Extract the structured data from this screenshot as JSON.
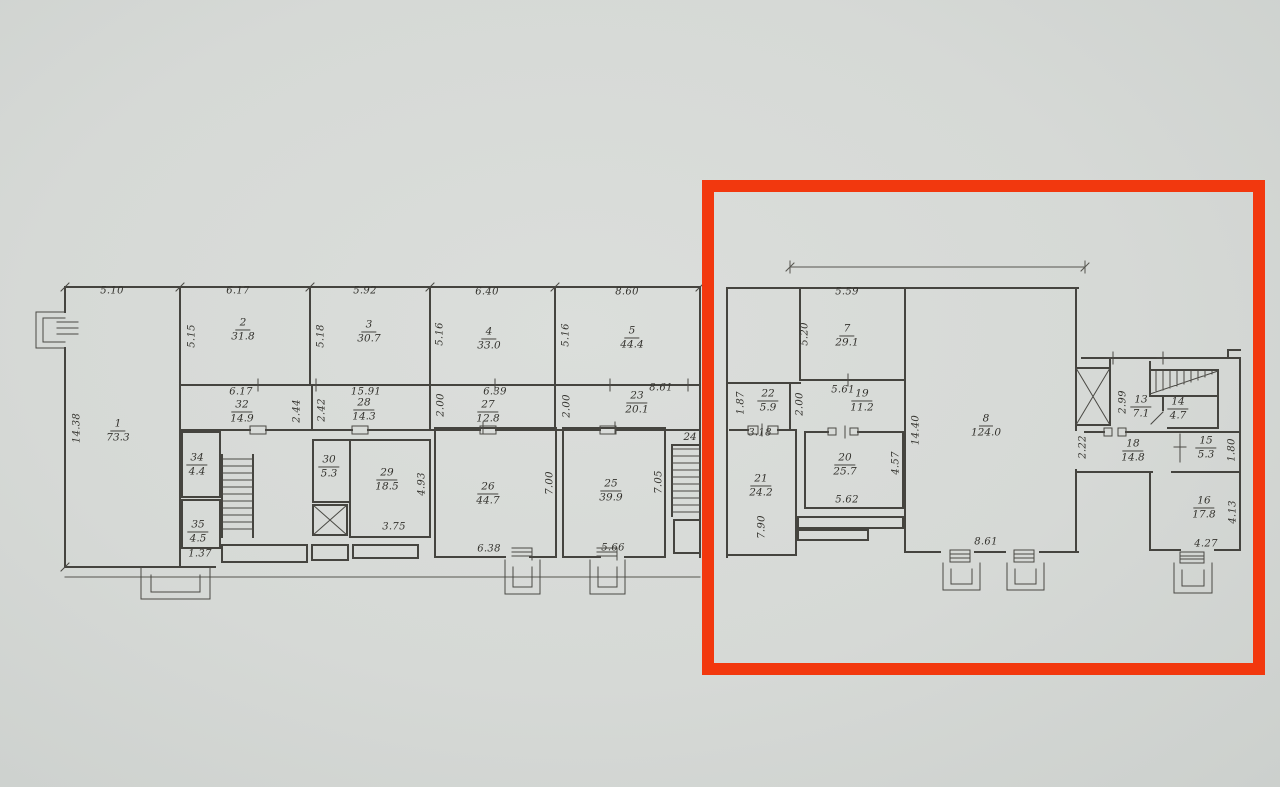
{
  "page": {
    "background_base": "#d6d9d6"
  },
  "highlight": {
    "color": "#f2380e",
    "x": 708,
    "y": 186,
    "width": 551,
    "height": 483,
    "stroke_width": 12
  },
  "plan": {
    "ink_color": "#45443f",
    "label_color": "#34332e",
    "rooms": [
      {
        "n": "1",
        "a": "73.3",
        "x": 118,
        "y": 431
      },
      {
        "n": "2",
        "a": "31.8",
        "x": 243,
        "y": 330
      },
      {
        "n": "3",
        "a": "30.7",
        "x": 369,
        "y": 332
      },
      {
        "n": "4",
        "a": "33.0",
        "x": 489,
        "y": 339
      },
      {
        "n": "5",
        "a": "44.4",
        "x": 632,
        "y": 338
      },
      {
        "n": "32",
        "a": "14.9",
        "x": 242,
        "y": 412
      },
      {
        "n": "28",
        "a": "14.3",
        "x": 364,
        "y": 410
      },
      {
        "n": "27",
        "a": "12.8",
        "x": 488,
        "y": 412
      },
      {
        "n": "23",
        "a": "20.1",
        "x": 637,
        "y": 403
      },
      {
        "n": "34",
        "a": "4.4",
        "x": 197,
        "y": 465
      },
      {
        "n": "35",
        "a": "4.5",
        "x": 198,
        "y": 532
      },
      {
        "n": "30",
        "a": "5.3",
        "x": 329,
        "y": 467
      },
      {
        "n": "29",
        "a": "18.5",
        "x": 387,
        "y": 480
      },
      {
        "n": "26",
        "a": "44.7",
        "x": 488,
        "y": 494
      },
      {
        "n": "25",
        "a": "39.9",
        "x": 611,
        "y": 491
      },
      {
        "n": "24",
        "a": "",
        "x": 690,
        "y": 438
      },
      {
        "n": "7",
        "a": "29.1",
        "x": 847,
        "y": 336
      },
      {
        "n": "22",
        "a": "5.9",
        "x": 768,
        "y": 401
      },
      {
        "n": "19",
        "a": "11.2",
        "x": 862,
        "y": 401
      },
      {
        "n": "21",
        "a": "24.2",
        "x": 761,
        "y": 486
      },
      {
        "n": "20",
        "a": "25.7",
        "x": 845,
        "y": 465
      },
      {
        "n": "8",
        "a": "124.0",
        "x": 986,
        "y": 426
      },
      {
        "n": "13",
        "a": "7.1",
        "x": 1141,
        "y": 407
      },
      {
        "n": "14",
        "a": "4.7",
        "x": 1178,
        "y": 409
      },
      {
        "n": "18",
        "a": "14.8",
        "x": 1133,
        "y": 451
      },
      {
        "n": "15",
        "a": "5.3",
        "x": 1206,
        "y": 448
      },
      {
        "n": "16",
        "a": "17.8",
        "x": 1204,
        "y": 508
      }
    ],
    "dims": [
      {
        "t": "5.10",
        "x": 112,
        "y": 291
      },
      {
        "t": "6.17",
        "x": 238,
        "y": 291
      },
      {
        "t": "5.92",
        "x": 365,
        "y": 291
      },
      {
        "t": "6.40",
        "x": 487,
        "y": 292
      },
      {
        "t": "8.60",
        "x": 627,
        "y": 292
      },
      {
        "t": "14.38",
        "x": 77,
        "y": 428,
        "v": 1
      },
      {
        "t": "5.15",
        "x": 192,
        "y": 336,
        "v": 1
      },
      {
        "t": "5.18",
        "x": 321,
        "y": 336,
        "v": 1
      },
      {
        "t": "5.16",
        "x": 440,
        "y": 334,
        "v": 1
      },
      {
        "t": "5.16",
        "x": 566,
        "y": 335,
        "v": 1
      },
      {
        "t": "6.17",
        "x": 241,
        "y": 392
      },
      {
        "t": "15.91",
        "x": 366,
        "y": 392
      },
      {
        "t": "6.39",
        "x": 495,
        "y": 392
      },
      {
        "t": "8.61",
        "x": 661,
        "y": 388
      },
      {
        "t": "2.44",
        "x": 297,
        "y": 411,
        "v": 1
      },
      {
        "t": "2.42",
        "x": 322,
        "y": 410,
        "v": 1
      },
      {
        "t": "2.00",
        "x": 441,
        "y": 405,
        "v": 1
      },
      {
        "t": "2.00",
        "x": 567,
        "y": 406,
        "v": 1
      },
      {
        "t": "1.37",
        "x": 200,
        "y": 554
      },
      {
        "t": "3.75",
        "x": 394,
        "y": 527
      },
      {
        "t": "4.93",
        "x": 422,
        "y": 484,
        "v": 1
      },
      {
        "t": "6.38",
        "x": 489,
        "y": 549
      },
      {
        "t": "7.00",
        "x": 550,
        "y": 483,
        "v": 1
      },
      {
        "t": "5.66",
        "x": 613,
        "y": 548
      },
      {
        "t": "7.05",
        "x": 659,
        "y": 482,
        "v": 1
      },
      {
        "t": "5.59",
        "x": 847,
        "y": 292
      },
      {
        "t": "5.20",
        "x": 805,
        "y": 334,
        "v": 1
      },
      {
        "t": "5.61",
        "x": 843,
        "y": 390
      },
      {
        "t": "1.87",
        "x": 741,
        "y": 403,
        "v": 1
      },
      {
        "t": "2.00",
        "x": 800,
        "y": 404,
        "v": 1
      },
      {
        "t": "3.18",
        "x": 760,
        "y": 433
      },
      {
        "t": "7.90",
        "x": 762,
        "y": 527,
        "v": 1
      },
      {
        "t": "5.62",
        "x": 847,
        "y": 500
      },
      {
        "t": "4.57",
        "x": 896,
        "y": 463,
        "v": 1
      },
      {
        "t": "14.40",
        "x": 916,
        "y": 430,
        "v": 1
      },
      {
        "t": "2.22",
        "x": 1083,
        "y": 447,
        "v": 1
      },
      {
        "t": "8.61",
        "x": 986,
        "y": 542
      },
      {
        "t": "2.99",
        "x": 1123,
        "y": 402,
        "v": 1
      },
      {
        "t": "1.80",
        "x": 1232,
        "y": 450,
        "v": 1
      },
      {
        "t": "4.13",
        "x": 1233,
        "y": 512,
        "v": 1
      },
      {
        "t": "4.27",
        "x": 1206,
        "y": 544
      }
    ]
  }
}
